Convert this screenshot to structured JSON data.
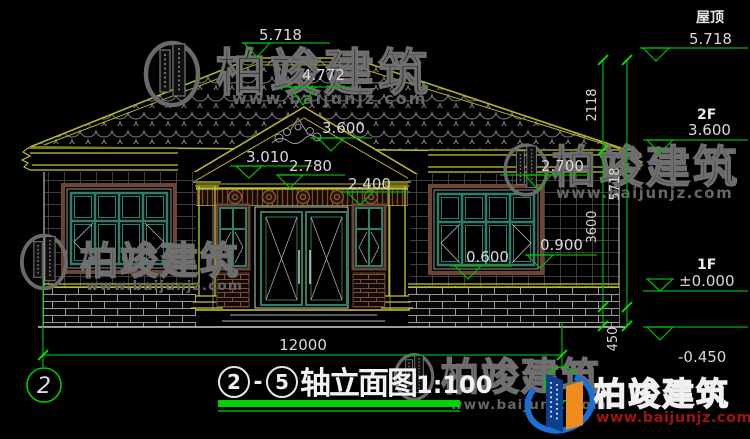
{
  "drawing": {
    "levels": {
      "ridge": "5.718",
      "gable_peak": "4.772",
      "porch_eave": "3.600",
      "cornice": "3.010",
      "gable_base": "2.780",
      "beam": "2.400",
      "right_eave": "2.700",
      "left_sill": "0.600",
      "right_sill": "0.900"
    },
    "right_annotations": {
      "roof_label": "屋顶",
      "roof_level": "5.718",
      "floor2_label": "2F",
      "floor2_level": "3.600",
      "floor1_label": "1F",
      "floor1_level": "±0.000",
      "plinth_level": "-0.450"
    },
    "vertical_dims": {
      "roof_to_f2": "2118",
      "total": "5718",
      "f2_to_ground": "3600",
      "plinth": "450"
    },
    "horizontal_dims": {
      "overall_width": "12000"
    },
    "axis_bubbles": {
      "left": "2"
    }
  },
  "title_block": {
    "axis_start": "2",
    "separator": "-",
    "axis_end": "5",
    "name": "轴立面图",
    "scale": "1:100"
  },
  "watermark": {
    "brand": "柏竣建筑",
    "site": "www.baijunjz.com"
  },
  "logo": {
    "brand": "柏竣建筑",
    "site": "www.baijunjz.com"
  }
}
